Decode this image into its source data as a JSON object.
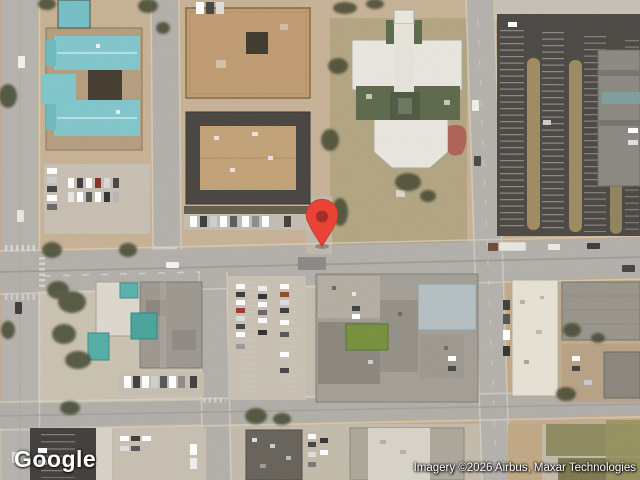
{
  "window": {
    "width": 640,
    "height": 480
  },
  "map": {
    "type": "satellite",
    "logo_text": "Google",
    "attribution_text": "Imagery ©2026 Airbus, Maxar Technologies",
    "marker": {
      "color": "#EA4335",
      "outline_color": "#C5392C",
      "dot_color": "#A03028",
      "position": {
        "x": 322,
        "y": 247
      }
    },
    "palette": {
      "ground_tan": "#c3ab8c",
      "road_gray": "#b2afaa",
      "asphalt_dark": "#4a4743",
      "teal_roof": "#7fc6ca",
      "white_roof": "#e9e6df",
      "green_roof": "#5c684a",
      "grass_olive": "#8d8a5f"
    }
  }
}
